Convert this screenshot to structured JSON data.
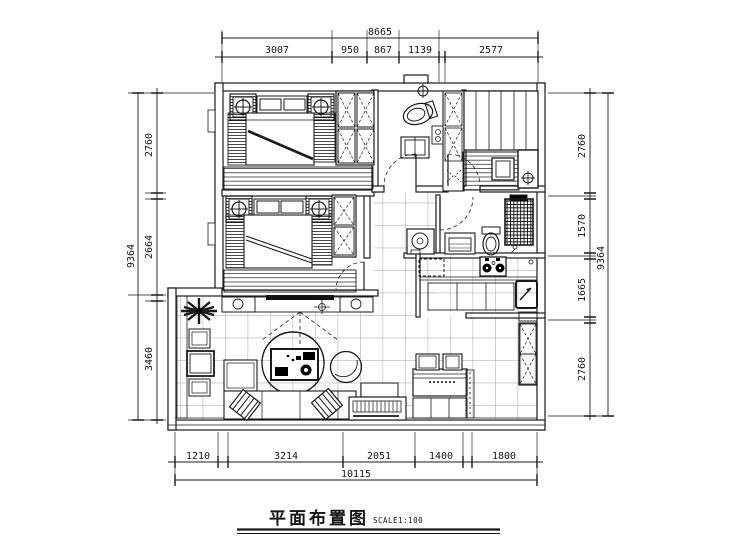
{
  "title": {
    "text": "平面布置图",
    "scale_label": "SCALE1:100"
  },
  "dimensions": {
    "top": {
      "total": "8665",
      "segments": [
        "3007",
        "950",
        "867",
        "1139",
        "2577"
      ]
    },
    "bottom": {
      "total": "10115",
      "segments": [
        "1210",
        "3214",
        "2051",
        "1400",
        "1800"
      ]
    },
    "left": {
      "total": "9364",
      "segments": [
        "2760",
        "2664",
        "3460"
      ]
    },
    "right": {
      "total": "9364",
      "segments": [
        "2760",
        "1570",
        "1665",
        "2760"
      ]
    }
  },
  "colors": {
    "line": "#1a1a1a",
    "background": "#ffffff",
    "grid": "#b5b5b5"
  }
}
